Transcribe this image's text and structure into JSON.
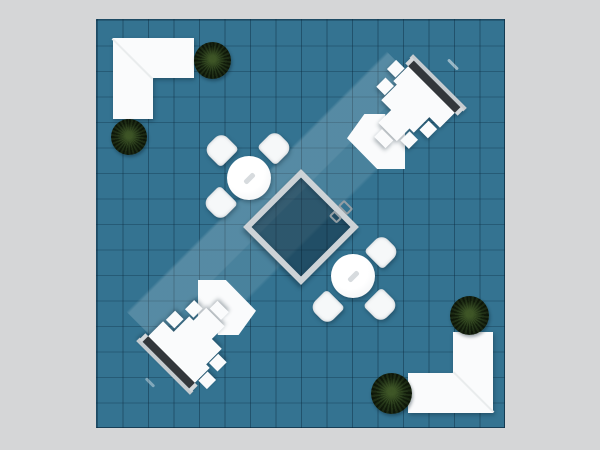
{
  "scene": {
    "background_color": "#d5d6d7",
    "floor": {
      "x": 96,
      "y": 19,
      "size": 409,
      "color": "#347391",
      "grid_cell_px": 25.5,
      "grid_line_color_v": "rgba(8,36,56,0.42)",
      "grid_line_color_h": "rgba(8,36,56,0.30)"
    },
    "light_band": {
      "x": 2.5,
      "y": 149.5,
      "length": 368,
      "width": 78
    },
    "highlights": [
      {
        "x": 349,
        "y": 43,
        "w": 14,
        "h": 3,
        "opacity": 0.5
      },
      {
        "x": 47,
        "y": 361,
        "w": 12,
        "h": 3,
        "opacity": 0.38
      }
    ],
    "meeting_room": {
      "x": 163,
      "y": 166,
      "size": 82,
      "frame_color": "#cdd3d7",
      "interior_color": "rgba(8,28,44,0.42)",
      "handles": [
        {
          "x": 241.5,
          "y": 182.5,
          "w": 13,
          "h": 9
        },
        {
          "x": 232.5,
          "y": 193,
          "w": 11,
          "h": 8
        }
      ]
    },
    "l_counters": [
      {
        "x": 16,
        "y": 18,
        "arms": [
          {
            "x": 0,
            "y": 0,
            "w": 81,
            "h": 40
          },
          {
            "x": 0,
            "y": 0,
            "w": 40,
            "h": 81
          }
        ],
        "seam": {
          "x": 0,
          "y": 0,
          "len": 57,
          "rot": 45
        }
      },
      {
        "x": 311,
        "y": 312,
        "arms": [
          {
            "x": 0,
            "y": 41,
            "w": 85,
            "h": 40
          },
          {
            "x": 45,
            "y": 0,
            "w": 40,
            "h": 81
          }
        ],
        "seam": {
          "x": 85,
          "y": 81,
          "len": 57,
          "rot": 225
        }
      }
    ],
    "workstations": [
      {
        "cx": 309,
        "cy": 95,
        "rot": 45,
        "monitor_color": "#33373b"
      },
      {
        "cx": 100,
        "cy": 314,
        "rot": 225,
        "monitor_color": "#33373b"
      }
    ],
    "arrow_counters": [
      {
        "x": 250,
        "y": 94,
        "w": 58,
        "h": 55,
        "shape": "arrow-tr"
      },
      {
        "x": 101,
        "y": 260,
        "w": 58,
        "h": 55,
        "shape": "arrow-bl"
      }
    ],
    "tables": [
      {
        "cx": 152,
        "cy": 158,
        "diameter": 44,
        "chairs": [
          {
            "dx": -28,
            "dy": -29,
            "rot": -45
          },
          {
            "dx": 26,
            "dy": -31,
            "rot": 45
          },
          {
            "dx": -29,
            "dy": 25,
            "rot": -135
          }
        ]
      },
      {
        "cx": 256,
        "cy": 256,
        "diameter": 44,
        "chairs": [
          {
            "dx": 28,
            "dy": 29,
            "rot": 135
          },
          {
            "dx": -26,
            "dy": 31,
            "rot": -135
          },
          {
            "dx": 29,
            "dy": -25,
            "rot": 45
          }
        ]
      }
    ],
    "plants": [
      {
        "cx": 115,
        "cy": 40,
        "d": 37
      },
      {
        "cx": 32,
        "cy": 117,
        "d": 36
      },
      {
        "cx": 372,
        "cy": 295,
        "d": 39
      },
      {
        "cx": 294,
        "cy": 373,
        "d": 41
      }
    ]
  }
}
